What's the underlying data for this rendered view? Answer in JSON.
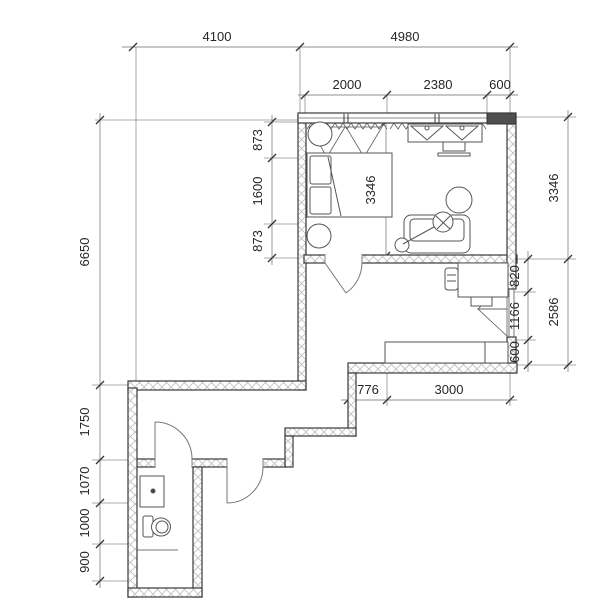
{
  "drawing": {
    "kind": "apartment floor plan"
  },
  "dimensions": {
    "top": [
      "4100",
      "4980"
    ],
    "top_sub": [
      "2000",
      "2380",
      "600"
    ],
    "bottom": [
      "776",
      "3000"
    ],
    "left_outer": [
      "6650",
      "1750",
      "1070",
      "1000",
      "900"
    ],
    "left_inner": [
      "873",
      "1600",
      "873"
    ],
    "interior": "3346",
    "right_inner": [
      "820",
      "1166",
      "600"
    ],
    "right_outer": [
      "3346",
      "2586"
    ]
  },
  "colors": {
    "background": "#ffffff",
    "wall_line": "#3a3a3a",
    "wall_hatch": "#c2c2c2",
    "solid_wall_fill": "#4f4f4f",
    "furniture_line": "#555555",
    "dimension_line": "#8f8f8f",
    "tick": "#333333",
    "text": "#262626"
  }
}
